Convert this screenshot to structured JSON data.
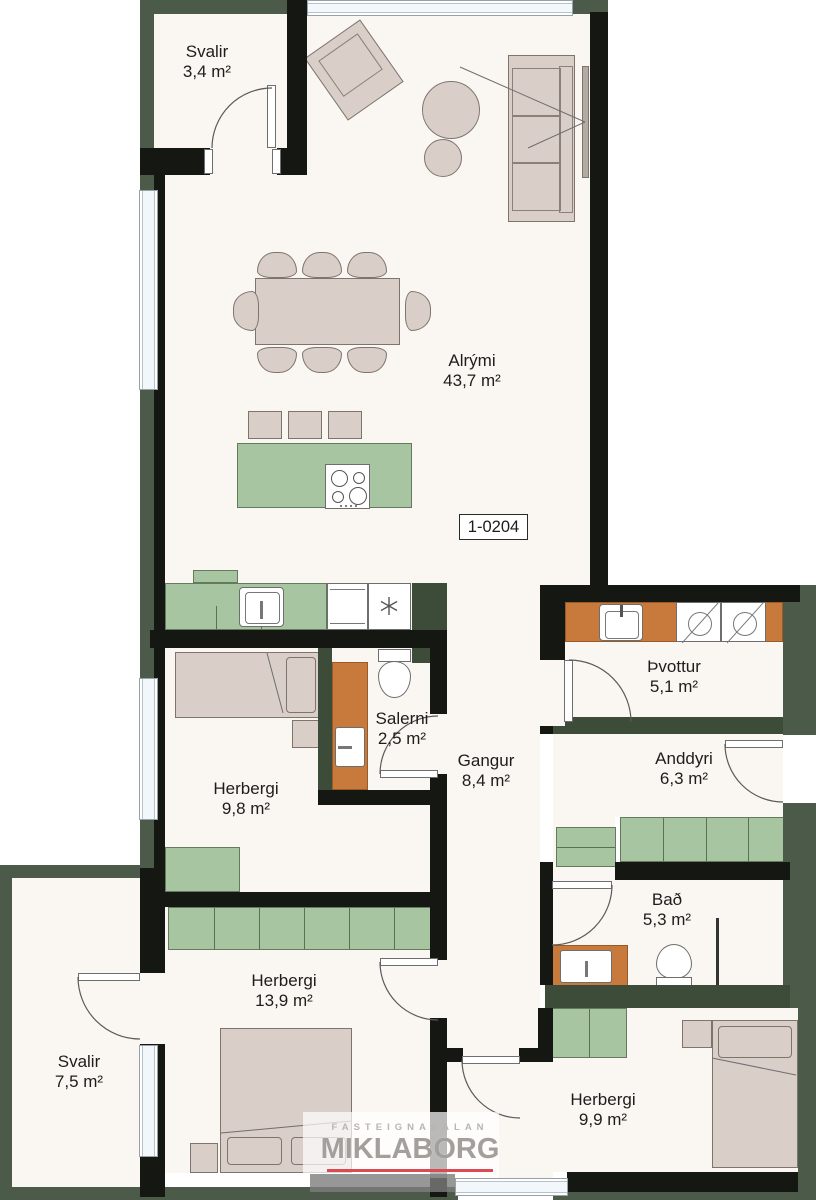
{
  "unit_label": "1-0204",
  "rooms": [
    {
      "id": "svalir-top",
      "name": "Svalir",
      "area": "3,4 m²"
    },
    {
      "id": "alrymi",
      "name": "Alrými",
      "area": "43,7 m²"
    },
    {
      "id": "thvottur",
      "name": "Þvottur",
      "area": "5,1 m²"
    },
    {
      "id": "salerni",
      "name": "Salerni",
      "area": "2,5 m²"
    },
    {
      "id": "gangur",
      "name": "Gangur",
      "area": "8,4 m²"
    },
    {
      "id": "anddyri",
      "name": "Anddyri",
      "area": "6,3 m²"
    },
    {
      "id": "herbergi-98",
      "name": "Herbergi",
      "area": "9,8 m²"
    },
    {
      "id": "bad",
      "name": "Bað",
      "area": "5,3 m²"
    },
    {
      "id": "herbergi-139",
      "name": "Herbergi",
      "area": "13,9 m²"
    },
    {
      "id": "svalir-bottom",
      "name": "Svalir",
      "area": "7,5 m²"
    },
    {
      "id": "herbergi-99",
      "name": "Herbergi",
      "area": "9,9 m²"
    }
  ],
  "logo": {
    "tagline": "FASTEIGNASALAN",
    "brand": "MIKLABORG"
  },
  "colors": {
    "exterior_wall_green": "#4c5b49",
    "interior_wall_black": "#151713",
    "interior_wall_green": "#3c4c39",
    "furniture_green": "#a7c5a0",
    "counter_orange": "#c8793c",
    "furniture_beige": "#d9cec8",
    "floor": "#faf7f2",
    "logo_red": "#d94a52",
    "logo_gray": "#a3a09b"
  }
}
